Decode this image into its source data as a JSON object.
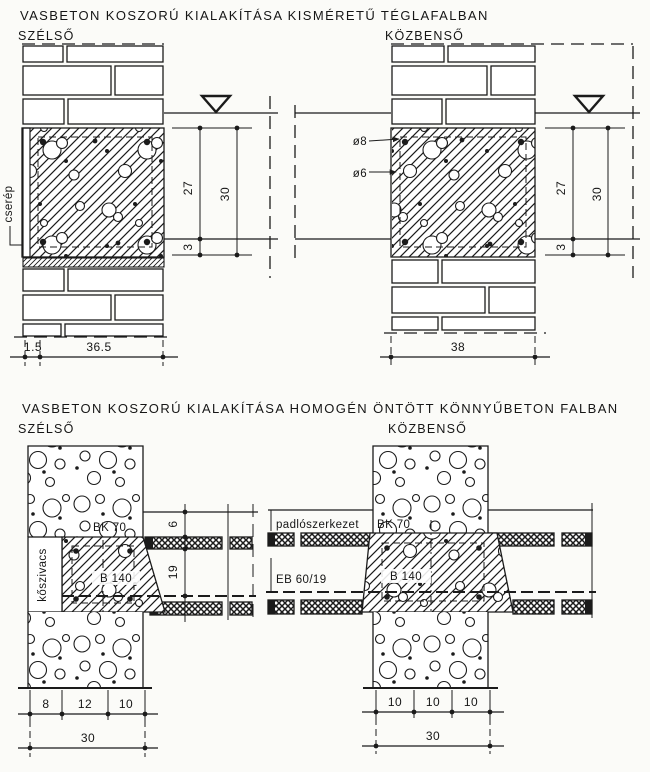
{
  "page": {
    "paper_color": "#fbfbf8",
    "ink_color": "#1b1b1b"
  },
  "top_section": {
    "title": "VASBETON KOSZORÚ KIALAKÍTÁSA KISMÉRETŰ TÉGLAFALBAN",
    "edge_detail": {
      "label": "SZÉLSŐ",
      "tile_label": "cserép",
      "dim_beam_height": "27",
      "dim_total_height": "30",
      "dim_bottom": "3",
      "dim_tile": "1.5",
      "dim_wall": "36.5"
    },
    "middle_detail": {
      "label": "KÖZBENSŐ",
      "rebar_top_label": "ø8",
      "rebar_bottom_label": "ø6",
      "dim_beam_height": "27",
      "dim_total_height": "30",
      "dim_bottom": "3",
      "dim_wall": "38"
    }
  },
  "bottom_section": {
    "title": "VASBETON KOSZORÚ KIALAKÍTÁSA HOMOGÉN ÖNTÖTT KÖNNYŰBETON FALBAN",
    "edge_detail": {
      "label": "SZÉLSŐ",
      "insulation_label": "kőszivacs",
      "wall_block_label": "BK 70",
      "beam_label": "B 140",
      "dim_floor_finish": "6",
      "dim_slab": "19",
      "dim_a": "8",
      "dim_b": "12",
      "dim_c": "10",
      "dim_total": "30"
    },
    "middle_detail": {
      "label": "KÖZBENSŐ",
      "floor_label": "padlószerkezet",
      "wall_block_label": "BK 70",
      "beam_label": "B 140",
      "slab_label": "EB 60/19",
      "dim_a": "10",
      "dim_b": "10",
      "dim_c": "10",
      "dim_total": "30"
    }
  }
}
